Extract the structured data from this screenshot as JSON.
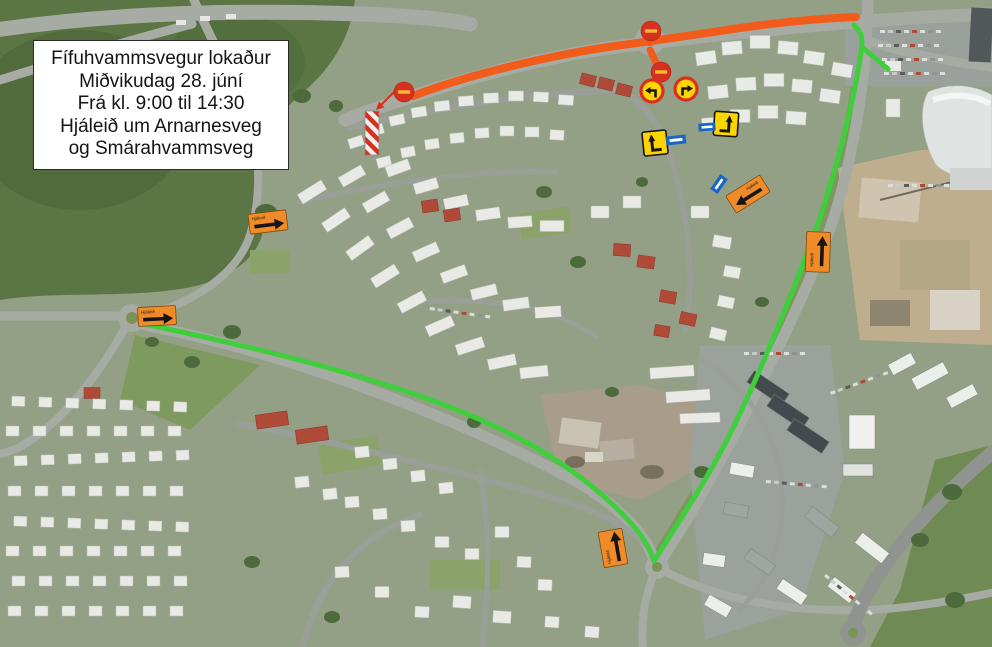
{
  "info_box": {
    "lines": [
      "Fífuhvammsvegur lokaður",
      "Miðvikudag 28. júní",
      "Frá kl. 9:00 til 14:30",
      "Hjáleið um Arnarnesveg",
      "og Smárahvammsveg"
    ]
  },
  "colors": {
    "closed_route": "#F25C1A",
    "detour_route": "#3FCE3C",
    "detour_sign_orange": "#F08B28",
    "prohibition_red": "#D7301F",
    "no_entry_bar_yellow": "#F6B733",
    "sign_yellow": "#FFD500",
    "one_way_blue": "#1767C8"
  },
  "signs": {
    "detour_arrow_label": "Hjáleið"
  }
}
